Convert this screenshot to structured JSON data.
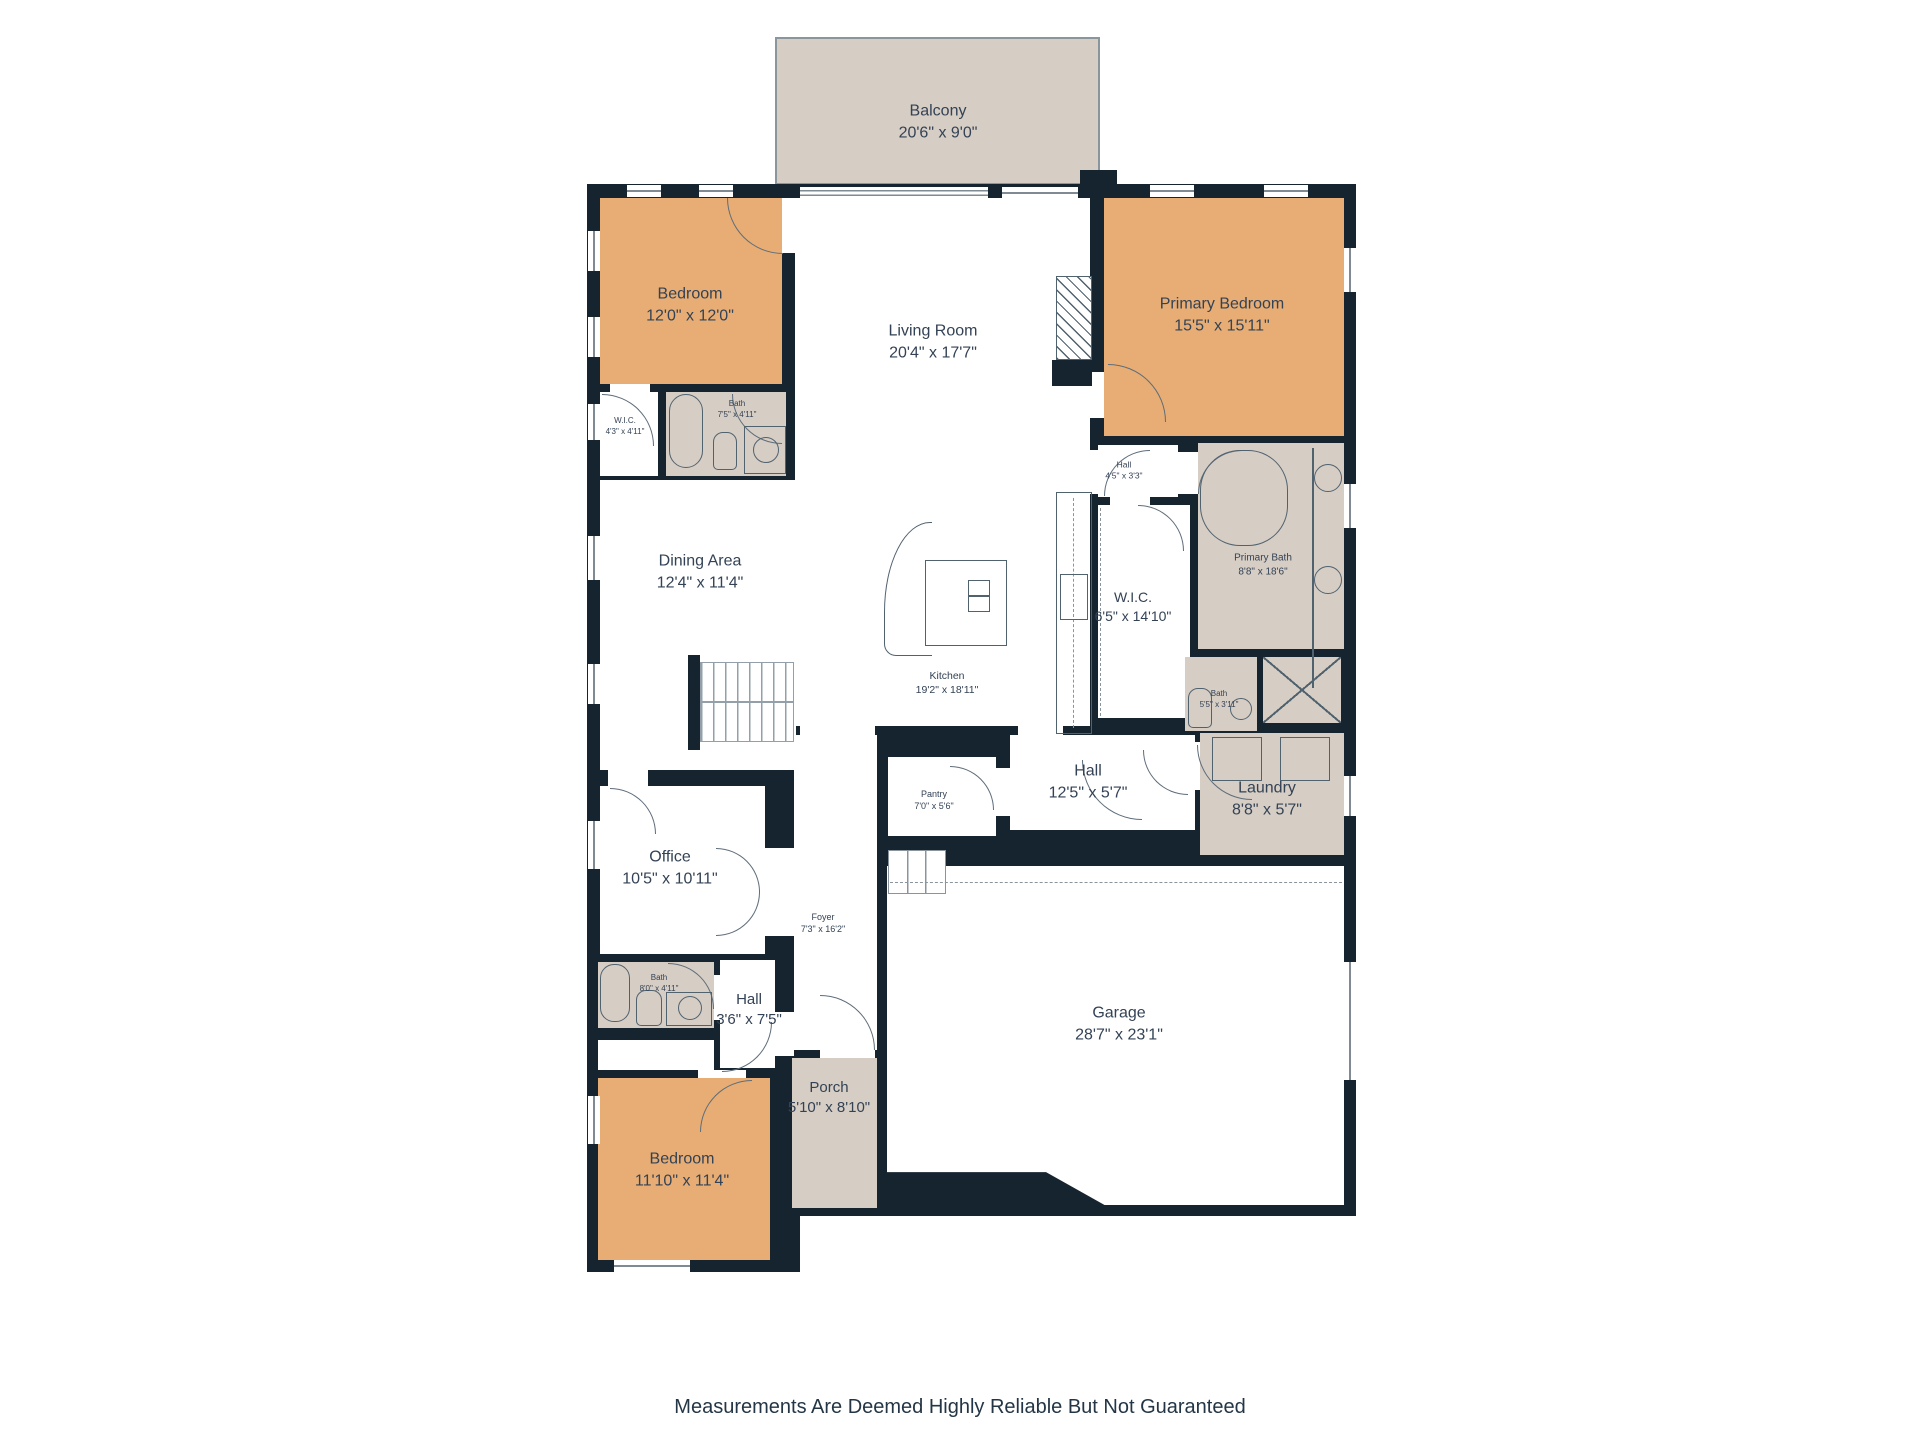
{
  "footer": {
    "disclaimer": "Measurements Are Deemed Highly Reliable But Not Guaranteed"
  },
  "palette": {
    "wall": "#16242f",
    "bedroom_fill": "#e7ad74",
    "soft_fill": "#d6cdc4",
    "floor": "#ffffff",
    "label_text": "#334255"
  },
  "rooms": {
    "balcony": {
      "name": "Balcony",
      "dims": "20'6\" x 9'0\""
    },
    "bedroom_top": {
      "name": "Bedroom",
      "dims": "12'0\" x 12'0\""
    },
    "primary_bedroom": {
      "name": "Primary Bedroom",
      "dims": "15'5\" x 15'11\""
    },
    "living_room": {
      "name": "Living Room",
      "dims": "20'4\" x 17'7\""
    },
    "wic_small": {
      "name": "W.I.C.",
      "dims": "4'3\" x 4'11\""
    },
    "bath_top": {
      "name": "Bath",
      "dims": "7'5\" x 4'11\""
    },
    "dining_area": {
      "name": "Dining Area",
      "dims": "12'4\" x 11'4\""
    },
    "hall_small": {
      "name": "Hall",
      "dims": "4'5\" x 3'3\""
    },
    "primary_bath": {
      "name": "Primary Bath",
      "dims": "8'8\" x 18'6\""
    },
    "wic": {
      "name": "W.I.C.",
      "dims": "6'5\" x 14'10\""
    },
    "kitchen": {
      "name": "Kitchen",
      "dims": "19'2\" x 18'11\""
    },
    "bath_mid": {
      "name": "Bath",
      "dims": "5'5\" x 3'11\""
    },
    "hall_center": {
      "name": "Hall",
      "dims": "12'5\" x 5'7\""
    },
    "laundry": {
      "name": "Laundry",
      "dims": "8'8\" x 5'7\""
    },
    "pantry": {
      "name": "Pantry",
      "dims": "7'0\" x 5'6\""
    },
    "office": {
      "name": "Office",
      "dims": "10'5\" x 10'11\""
    },
    "foyer": {
      "name": "Foyer",
      "dims": "7'3\" x 16'2\""
    },
    "bath_lower": {
      "name": "Bath",
      "dims": "8'0\" x 4'11\""
    },
    "hall_lower": {
      "name": "Hall",
      "dims": "3'6\" x 7'5\""
    },
    "porch": {
      "name": "Porch",
      "dims": "5'10\" x 8'10\""
    },
    "bedroom_bottom": {
      "name": "Bedroom",
      "dims": "11'10\" x 11'4\""
    },
    "garage": {
      "name": "Garage",
      "dims": "28'7\" x 23'1\""
    }
  }
}
